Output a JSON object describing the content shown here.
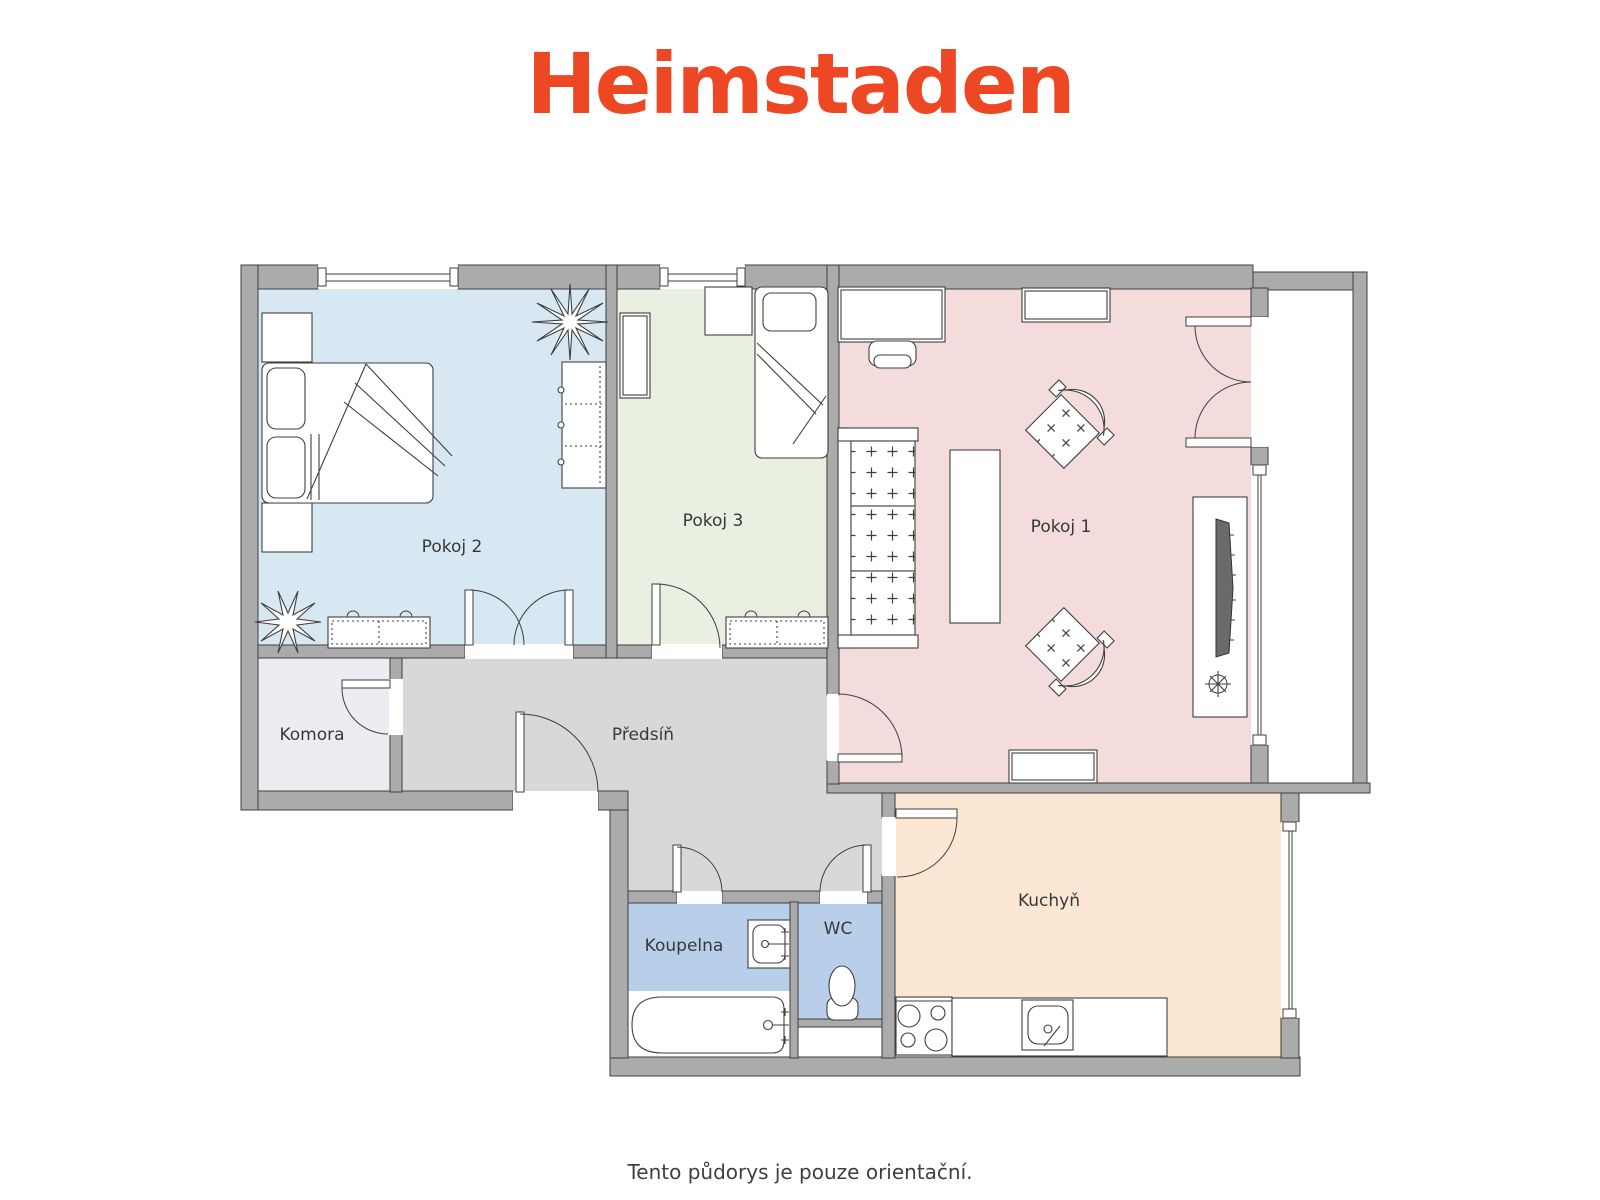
{
  "logo": {
    "text": "Heimstaden",
    "color": "#ee4723"
  },
  "caption": "Tento půdorys je pouze orientační.",
  "rooms": {
    "pokoj1": {
      "label": "Pokoj 1",
      "color": "#f3dcdb"
    },
    "pokoj2": {
      "label": "Pokoj 2",
      "color": "#d7e8f2"
    },
    "pokoj3": {
      "label": "Pokoj 3",
      "color": "#e9efe1"
    },
    "komora": {
      "label": "Komora",
      "color": "#edecf3"
    },
    "predsin": {
      "label": "Předsíň",
      "color": "#d8d8d8"
    },
    "koupelna": {
      "label": "Koupelna",
      "color": "#b9cfe9"
    },
    "wc": {
      "label": "WC",
      "color": "#b9cfe9"
    },
    "kuchyn": {
      "label": "Kuchyň",
      "color": "#fbe7d3"
    }
  },
  "colors": {
    "wall": "#ababab",
    "wall_outline": "#3f3f3f",
    "furniture_outline": "#3f3f3f",
    "background": "#ffffff"
  }
}
